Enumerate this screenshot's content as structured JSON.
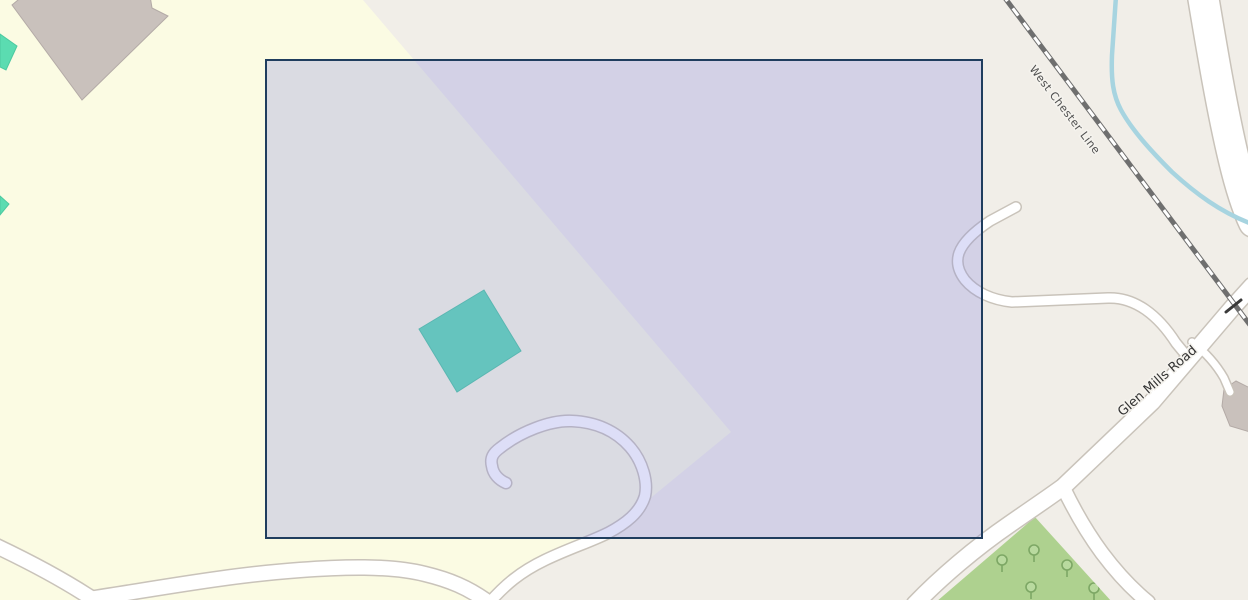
{
  "map": {
    "labels": {
      "railway": "West Chester Line",
      "road": "Glen Mills Road"
    },
    "selection": {
      "x": 266,
      "y": 60,
      "width": 716,
      "height": 478
    },
    "colors": {
      "land": "#f1eee8",
      "farmland": "#fbfbe3",
      "orchard": "#aed18f",
      "orchard_tree": "#7da765",
      "orchard_tree_fill": "#b9da9f",
      "building": "#c9c1bc",
      "building_outline": "#b3aaa6",
      "building_mint": "#5bdcb1",
      "building_mint_outline": "#4cc9a0",
      "road_fill": "#ffffff",
      "road_casing": "#c9c3ba",
      "railway": "#6f6f6f",
      "railway_dash": "#ffffff",
      "stream": "#a7d4e0",
      "label": "#333333",
      "label_rail": "#4f4f4f",
      "label_halo": "#f5f3ee",
      "selection_fill": "rgba(130,133,225,0.27)",
      "selection_border": "#1f3d5e"
    }
  }
}
